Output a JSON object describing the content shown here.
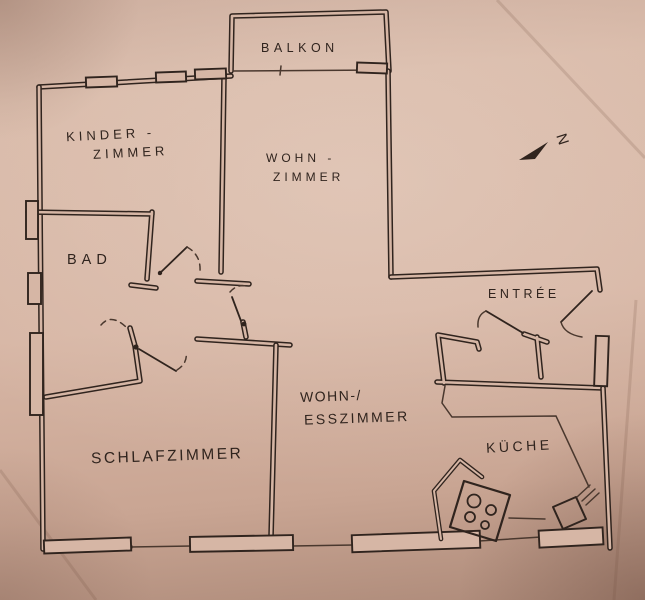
{
  "title": "Hand-drawn apartment floor plan",
  "palette": {
    "ink": "#30241e",
    "paper": "#d6b6a5"
  },
  "rooms": {
    "balkon": {
      "label": "BALKON"
    },
    "kinder": {
      "line1": "KINDER -",
      "line2": "ZIMMER"
    },
    "wohn": {
      "line1": "WOHN -",
      "line2": "ZIMMER"
    },
    "bad": {
      "label": "BAD"
    },
    "entree": {
      "label": "ENTRÉE"
    },
    "wohness": {
      "line1": "WOHN-/",
      "line2": "ESSZIMMER"
    },
    "schlaf": {
      "label": "SCHLAFZIMMER"
    },
    "kueche": {
      "label": "KÜCHE"
    }
  },
  "compass": {
    "label": "N"
  },
  "icons": {
    "stove": "stove-burners-icon",
    "sink": "sink-icon",
    "north": "north-arrow-icon"
  }
}
